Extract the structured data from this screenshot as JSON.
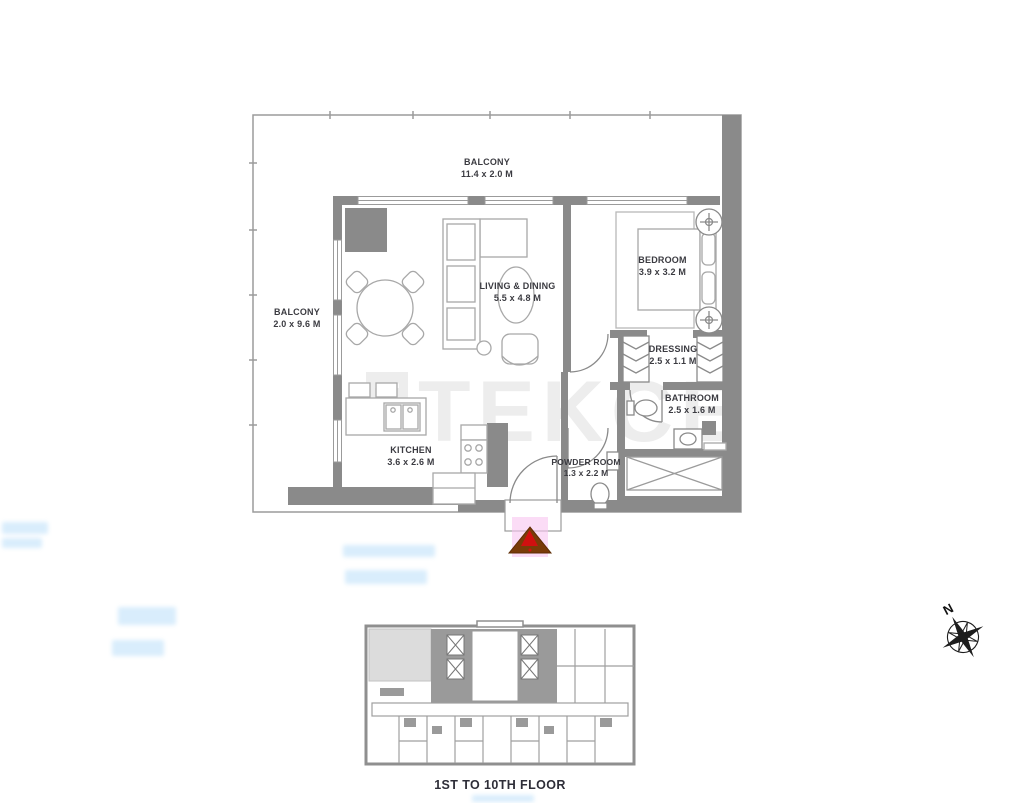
{
  "plan": {
    "watermark_logo": "T",
    "watermark_text": "TEKCE",
    "rooms": {
      "balcony_top": {
        "name": "BALCONY",
        "dims": "11.4 x 2.0 M"
      },
      "balcony_left": {
        "name": "BALCONY",
        "dims": "2.0 x 9.6 M"
      },
      "living_dining": {
        "name": "LIVING & DINING",
        "dims": "5.5 x 4.8 M"
      },
      "bedroom": {
        "name": "BEDROOM",
        "dims": "3.9 x 3.2 M"
      },
      "dressing": {
        "name": "DRESSING",
        "dims": "2.5 x 1.1 M"
      },
      "bathroom": {
        "name": "BATHROOM",
        "dims": "2.5 x 1.6 M"
      },
      "kitchen": {
        "name": "KITCHEN",
        "dims": "3.6 x 2.6 M"
      },
      "powder_room": {
        "name": "POWDER ROOM",
        "dims": "1.3 x 2.2 M"
      }
    }
  },
  "key_plan": {
    "caption": "1ST TO 10TH FLOOR"
  },
  "compass": {
    "label": "N"
  },
  "colors": {
    "wall_gray": "#8a8a8a",
    "outline_gray": "#9b9b9b",
    "furniture_gray": "#a8a8a8",
    "label_dark": "#3b3b41",
    "watermark_gray": "#ededed",
    "keyplan_gray": "#8f8f8f",
    "highlight_unit_gray": "#dcdcdc",
    "entrance_arrow_brown": "#7a3b08",
    "entrance_arrow_red": "#d01010",
    "entrance_glow_pink": "#f9c4f0",
    "smudge_blue": "#badefa"
  }
}
